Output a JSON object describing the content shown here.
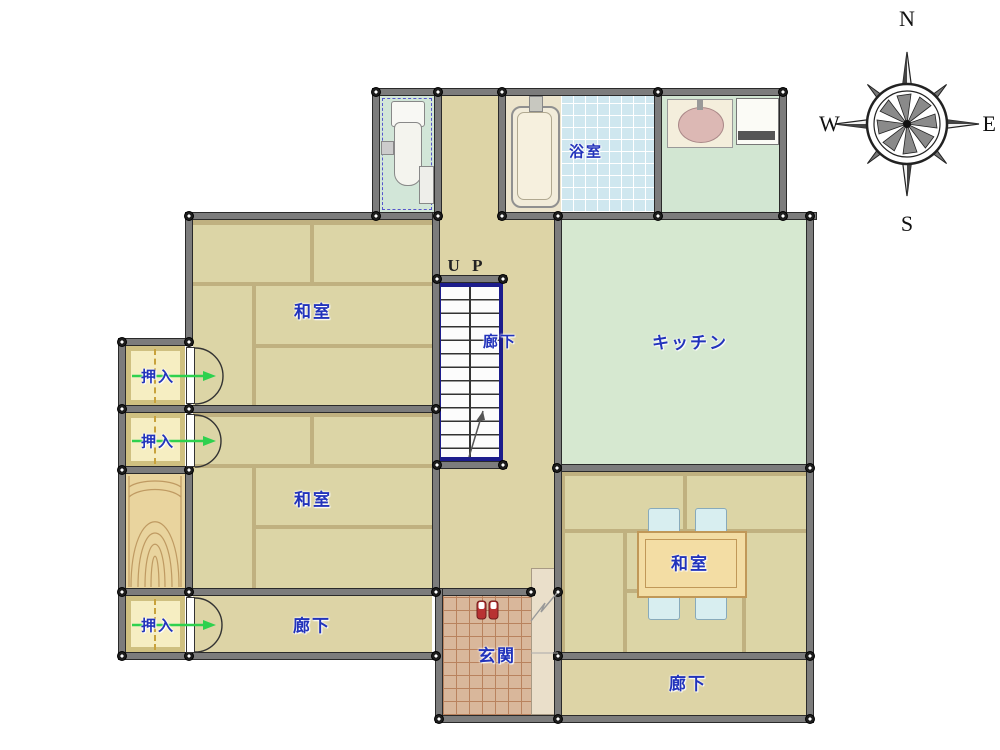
{
  "labels": {
    "washitsu": "和室",
    "oshiire": "押入",
    "rouka": "廊下",
    "kitchen": "キッチン",
    "bathroom": "浴室",
    "genkan": "玄関",
    "up": "U P"
  },
  "compass": {
    "north": "N",
    "east": "E",
    "south": "S",
    "west": "W"
  },
  "colors": {
    "wall_gray": "#7c7c7c",
    "tatami_mat": "#dcd5a6",
    "tatami_gap": "#c0b180",
    "corridor_floor": "#ddd4a6",
    "kitchen_floor": "#d6e8d0",
    "washroom_floor": "#d2e6d2",
    "bath_tile": "#cfe7ef",
    "genkan_tile": "#d9b79b",
    "closet_cream": "#f6eec2",
    "wood_floor": "#e9d49e",
    "label_blue": "#2233bb",
    "stairs_navy": "#1c1c8c",
    "door_arrow_green": "#2ed14e",
    "shoes_red": "#b83232"
  }
}
